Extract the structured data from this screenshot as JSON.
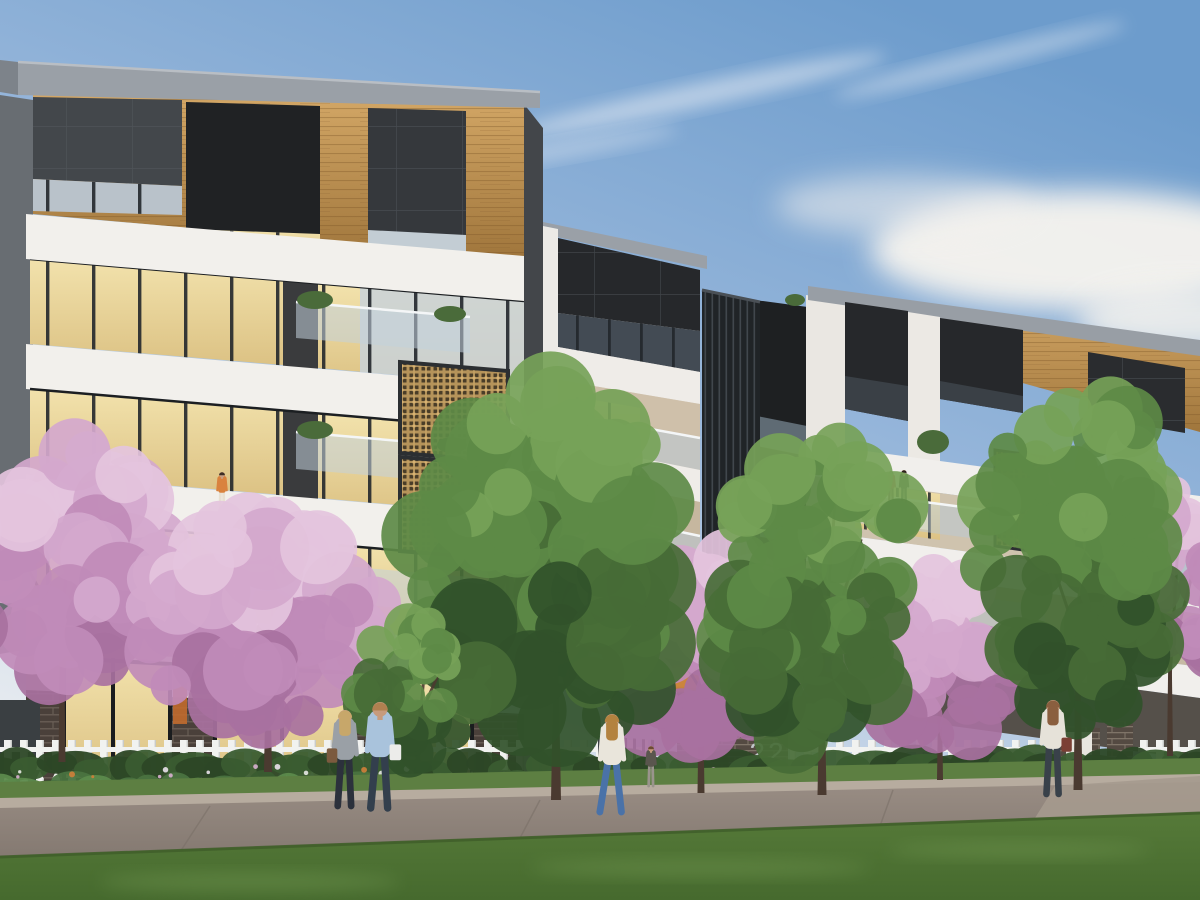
{
  "scene": {
    "description": "Dusk architectural render of a modern multi-block apartment development behind a white picket fence, with flowering pink blossom trees, green street trees, a footpath and lawn in the foreground",
    "time_of_day": "dusk",
    "entry": {
      "street_number": "22"
    },
    "palette": {
      "fascia_grey": "#9aa0a7",
      "charcoal_panel": "#26282b",
      "timber_light": "#d3a766",
      "timber_dark": "#a0763c",
      "white_wall": "#f2f0ec",
      "beige_wall": "#cfc0aa",
      "warm_window_light": "#f2e2ac",
      "warm_window_deep": "#dcc284",
      "glass_light": "#d3dde4",
      "glass_deep": "#a9bcc9",
      "gold_screen": "#b5935a",
      "gold_screen_dark": "#4a3d28",
      "brick_base": "#4a403a",
      "brick_entry": "#544a42",
      "fence_white": "#f1f2f0",
      "number_grey": "#c2c7ca",
      "entry_glow": "#e8953f"
    },
    "sky": {
      "top": "#6d9ccc",
      "mid": "#9bb9dc",
      "low": "#cfdbe9",
      "horizon": "#eef0f2",
      "cloud": "#f7f4ef"
    },
    "buildings": [
      {
        "id": "block-left",
        "label": "Left apartment block",
        "features": [
          "grey roof fascia",
          "timber-lined top floor recess",
          "charcoal panel boxes",
          "white horizontal balcony bands",
          "warm lit ribbon windows",
          "glass balustrades",
          "two gold fretwork privacy screens",
          "brick ground floor with lit glazing"
        ]
      },
      {
        "id": "block-middle",
        "label": "Middle apartment block",
        "features": [
          "grey roof cap",
          "charcoal top storey",
          "beige balcony walls",
          "glass balustrades",
          "dark vertical louvre blade wall",
          "warm lit entry at ground level"
        ]
      },
      {
        "id": "block-right",
        "label": "Right apartment block",
        "features": [
          "grey roof band",
          "timber soffit",
          "charcoal panel boxes",
          "white spandrel bands",
          "gold fretwork screen",
          "balcony with two residents"
        ]
      }
    ],
    "vegetation": {
      "blossom_palette": [
        "#a8719f",
        "#c08bb8",
        "#d4a8cd",
        "#e4c4dd"
      ],
      "green_palette": [
        "#31512a",
        "#466b36",
        "#5d8a46",
        "#76a258"
      ],
      "shrub_palette": [
        "#2c4726",
        "#3a5c30",
        "#4a7340",
        "#5c8a4c"
      ],
      "flower_palette": [
        "#d8b0d0",
        "#eae2ec",
        "#d0803a",
        "#e8e8e4"
      ],
      "trunk_color": "#4a3a30",
      "trees": [
        {
          "id": "blossom-left-edge",
          "kind": "blossom",
          "cx": 55,
          "cy": 560,
          "rx": 110,
          "ry": 125,
          "blobs": 55,
          "seed": 11,
          "trunk": {
            "x": 62,
            "top": 600,
            "bottom": 762,
            "w": 7
          }
        },
        {
          "id": "blossom-left",
          "kind": "blossom",
          "cx": 258,
          "cy": 622,
          "rx": 118,
          "ry": 112,
          "blobs": 62,
          "seed": 23,
          "trunk": {
            "x": 268,
            "top": 640,
            "bottom": 772,
            "w": 8
          }
        },
        {
          "id": "blossom-entry",
          "kind": "blossom",
          "cx": 703,
          "cy": 645,
          "rx": 102,
          "ry": 102,
          "blobs": 58,
          "seed": 37,
          "trunk": {
            "x": 701,
            "top": 660,
            "bottom": 793,
            "w": 7
          }
        },
        {
          "id": "blossom-right",
          "kind": "blossom",
          "cx": 938,
          "cy": 655,
          "rx": 90,
          "ry": 88,
          "blobs": 46,
          "seed": 41,
          "trunk": {
            "x": 940,
            "top": 672,
            "bottom": 780,
            "w": 6
          }
        },
        {
          "id": "blossom-far-right",
          "kind": "blossom",
          "cx": 1168,
          "cy": 580,
          "rx": 80,
          "ry": 100,
          "blobs": 46,
          "seed": 53,
          "trunk": {
            "x": 1170,
            "top": 640,
            "bottom": 756,
            "w": 6
          }
        },
        {
          "id": "green-center",
          "kind": "green",
          "cx": 548,
          "cy": 570,
          "rx": 130,
          "ry": 190,
          "blobs": 88,
          "seed": 61,
          "trunk": {
            "x": 556,
            "top": 620,
            "bottom": 800,
            "w": 10
          }
        },
        {
          "id": "green-mid-right",
          "kind": "green",
          "cx": 822,
          "cy": 598,
          "rx": 98,
          "ry": 168,
          "blobs": 72,
          "seed": 71,
          "trunk": {
            "x": 822,
            "top": 640,
            "bottom": 795,
            "w": 9
          }
        },
        {
          "id": "green-right",
          "kind": "green",
          "cx": 1078,
          "cy": 558,
          "rx": 95,
          "ry": 182,
          "blobs": 76,
          "seed": 83,
          "trunk": {
            "x": 1078,
            "top": 610,
            "bottom": 790,
            "w": 9
          }
        },
        {
          "id": "green-small",
          "kind": "green",
          "cx": 418,
          "cy": 688,
          "rx": 64,
          "ry": 72,
          "blobs": 36,
          "seed": 97,
          "trunk": {
            "x": 418,
            "top": 700,
            "bottom": 770,
            "w": 5
          }
        }
      ]
    },
    "people": [
      {
        "id": "woman-of-couple",
        "layer": "street",
        "x": 345,
        "footY": 806,
        "h": 96,
        "shirt": "#9aa0a6",
        "pants": "#2c313c",
        "hair": "#c7a76a",
        "skin": "#caa083",
        "hairLong": true,
        "bag": "#7b5a3e",
        "bagSide": -1,
        "stride": 6
      },
      {
        "id": "man-of-couple",
        "layer": "street",
        "x": 380,
        "footY": 808,
        "h": 106,
        "shirt": "#a9c3dc",
        "pants": "#333f4d",
        "hair": "#b08050",
        "skin": "#c79b7d",
        "bag": "#ececea",
        "bagSide": 1,
        "stride": 8
      },
      {
        "id": "woman-walking",
        "layer": "street",
        "x": 612,
        "footY": 812,
        "h": 98,
        "shirt": "#e9e5db",
        "pants": "#4a72a8",
        "hair": "#b3823f",
        "skin": "#c79b7d",
        "hairLong": true,
        "stride": 14
      },
      {
        "id": "person-entry-path",
        "layer": "street",
        "x": 651,
        "footY": 786,
        "h": 40,
        "shirt": "#5a564e",
        "pants": "#9a948c",
        "hair": "#6b4a33",
        "skin": "#c79b7d",
        "stride": 3
      },
      {
        "id": "person-driveway",
        "layer": "street",
        "x": 1053,
        "footY": 794,
        "h": 94,
        "shirt": "#e6e2d9",
        "pants": "#39414a",
        "hair": "#8a5f3f",
        "skin": "#c79b7d",
        "hairLong": true,
        "bag": "#7b3f34",
        "bagSide": 1,
        "stride": 5
      },
      {
        "id": "woman-in-window",
        "layer": "building",
        "x": 222,
        "footY": 512,
        "h": 40,
        "shirt": "#d9823e",
        "pants": "#e8e0d2",
        "hair": "#3f2f26",
        "skin": "#caa083",
        "stride": 2
      },
      {
        "id": "balcony-resident-a",
        "layer": "building",
        "x": 891,
        "footY": 505,
        "h": 34,
        "shirt": "#b85a50",
        "pants": "#6b4a44",
        "hair": "#3a2c24",
        "skin": "#caa083",
        "stride": 2
      },
      {
        "id": "balcony-resident-b",
        "layer": "building",
        "x": 904,
        "footY": 506,
        "h": 36,
        "shirt": "#2e3236",
        "pants": "#2e3236",
        "hair": "#2a211c",
        "skin": "#caa083",
        "stride": 2
      },
      {
        "id": "balcony-figure-middle-block",
        "layer": "building",
        "x": 566,
        "footY": 450,
        "h": 28,
        "shirt": "#dfe3e8",
        "pants": "#cfd3d8",
        "hair": "#caa083",
        "skin": "#caa083",
        "stride": 2
      }
    ],
    "fence": {
      "color": "#f1f2f0",
      "rail_y": 747,
      "segments": [
        {
          "x1": 0,
          "x2": 648
        },
        {
          "x1": 790,
          "x2": 1058
        },
        {
          "x1": 1138,
          "x2": 1200
        }
      ]
    },
    "ground": {
      "grass_strip": "#5d7f42",
      "kerb": "#b7ac9f",
      "footpath": "#8d8078",
      "driveway": "#a59a8e",
      "lawn": "#567a39",
      "lawn_deep": "#466a2e",
      "lawn_streak": "#7da35a"
    }
  }
}
